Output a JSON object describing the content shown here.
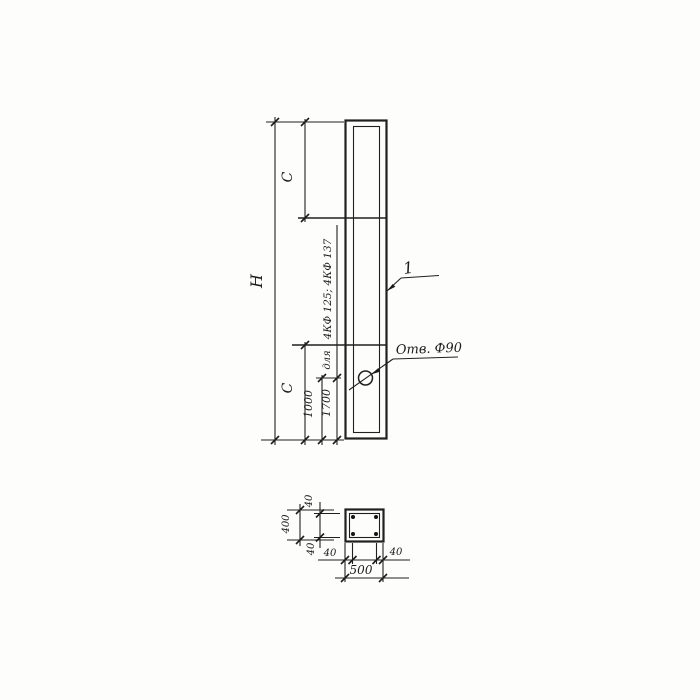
{
  "meta": {
    "kind": "hand-drawn structural drawing",
    "paper_color": "#fdfdfc",
    "ink_color": "#202020"
  },
  "elevation": {
    "dim_total_height": "H",
    "dim_top_segment": "C",
    "dim_bottom_segment": "C",
    "dim_hole_offset_1": "1000",
    "dim_hole_offset_2": "1700",
    "note_types": "4КФ 125; 4КФ 137",
    "note_for": "для",
    "hole_callout": "Отв. Ф90",
    "part_number": "1"
  },
  "section": {
    "dim_width_total": "500",
    "dim_height_total": "400",
    "dim_cover_top": "40",
    "dim_cover_bottom": "40",
    "dim_cover_left": "40",
    "dim_cover_right": "40"
  }
}
